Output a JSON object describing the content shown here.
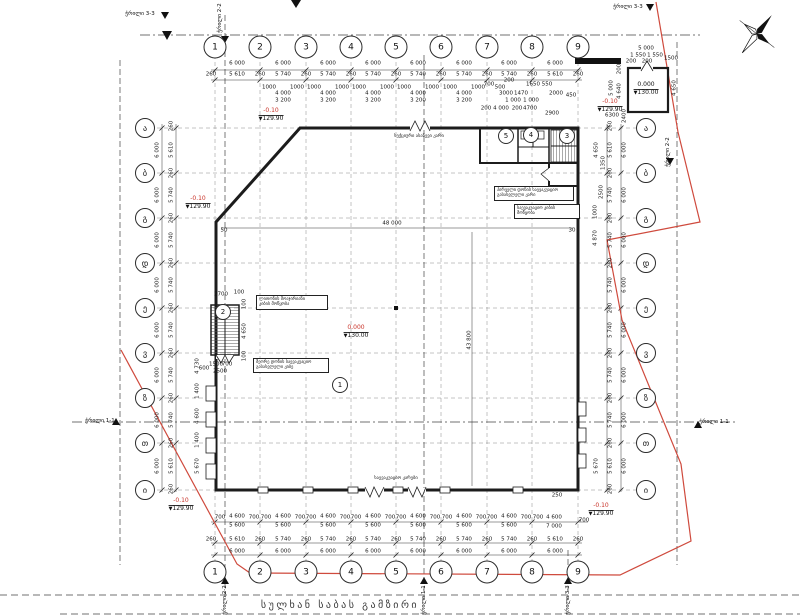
{
  "street_title": "სულხან საბას გამზირი",
  "colors": {
    "boundary_red": "#cf4a3d",
    "elevation_red": "#c9342a",
    "line_dark": "#1c1c1c"
  },
  "compass": {
    "name": "north-arrow",
    "x": 757,
    "y": 33
  },
  "axes": {
    "cols": [
      {
        "label": "1",
        "x": 215
      },
      {
        "label": "2",
        "x": 260
      },
      {
        "label": "3",
        "x": 306
      },
      {
        "label": "4",
        "x": 351
      },
      {
        "label": "5",
        "x": 396
      },
      {
        "label": "6",
        "x": 441
      },
      {
        "label": "7",
        "x": 487
      },
      {
        "label": "8",
        "x": 532
      },
      {
        "label": "9",
        "x": 578
      }
    ],
    "col_top_y": 47,
    "col_bottom_y": 572,
    "rows": [
      {
        "label": "ა",
        "y": 128
      },
      {
        "label": "ბ",
        "y": 173
      },
      {
        "label": "გ",
        "y": 218
      },
      {
        "label": "დ",
        "y": 263
      },
      {
        "label": "ე",
        "y": 308
      },
      {
        "label": "ვ",
        "y": 353
      },
      {
        "label": "ზ",
        "y": 398
      },
      {
        "label": "თ",
        "y": 443
      },
      {
        "label": "ი",
        "y": 490
      }
    ],
    "row_left_x": 145,
    "row_right_x": 646
  },
  "rooms": [
    {
      "n": "1",
      "x": 340,
      "y": 385
    },
    {
      "n": "2",
      "x": 223,
      "y": 312
    },
    {
      "n": "5",
      "x": 506,
      "y": 136
    },
    {
      "n": "4",
      "x": 531,
      "y": 135
    },
    {
      "n": "3",
      "x": 567,
      "y": 136
    }
  ],
  "elevations": [
    {
      "level": "-0.10",
      "abs": "129.90",
      "x": 271,
      "y": 108
    },
    {
      "level": "-0.10",
      "abs": "129.90",
      "x": 198,
      "y": 196
    },
    {
      "level": "-0.10",
      "abs": "129.90",
      "x": 610,
      "y": 99
    },
    {
      "level": "0.000",
      "abs": "130.00",
      "x": 356,
      "y": 325
    },
    {
      "level": "-0.10",
      "abs": "129.90",
      "x": 181,
      "y": 498
    },
    {
      "level": "-0.10",
      "abs": "129.90",
      "x": 601,
      "y": 503
    },
    {
      "level": "0.000",
      "abs": "130.00",
      "x": 646,
      "y": 82,
      "plain": true
    }
  ],
  "callouts": [
    {
      "x": 256,
      "y": 295,
      "w": 66,
      "lines": [
        "ლითონის მოაჯირიანი",
        "კიბის მოწყობა"
      ]
    },
    {
      "x": 253,
      "y": 358,
      "w": 70,
      "lines": [
        "მეორე დონის საევაკუაციო",
        "გასასვლელი კიბე"
      ]
    },
    {
      "x": 494,
      "y": 186,
      "w": 74,
      "lines": [
        "პირველი დონის საევაკუაციო",
        "გასასვლელი კარი"
      ]
    },
    {
      "x": 514,
      "y": 204,
      "w": 60,
      "lines": [
        "საევაკუაციო კიბის",
        "მოწყობა"
      ]
    }
  ],
  "plain_labels": [
    {
      "t": "სექციური ასაწევი კარი",
      "x": 419,
      "y": 134
    },
    {
      "t": "საევაკუაციო კარები",
      "x": 396,
      "y": 476
    }
  ],
  "sections": [
    {
      "t": "ჭრილი 2-2",
      "x": 220,
      "y": 18,
      "r": 1
    },
    {
      "t": "ჭრილი 2-2",
      "x": 225,
      "y": 600,
      "r": 1
    },
    {
      "t": "ჭრილი 1-1",
      "x": 424,
      "y": 600,
      "r": 1
    },
    {
      "t": "ჭრილი 3-3",
      "x": 568,
      "y": 600,
      "r": 1
    },
    {
      "t": "ჭრილი 1-1",
      "x": 100,
      "y": 421,
      "r": 0
    },
    {
      "t": "ჭრილი 1-1",
      "x": 714,
      "y": 422,
      "r": 0
    },
    {
      "t": "ჭრილი 2-2",
      "x": 668,
      "y": 152,
      "r": 1
    },
    {
      "t": "ჭრილი 3-3",
      "x": 140,
      "y": 14,
      "r": 0
    },
    {
      "t": "ჭრილი 3-3",
      "x": 628,
      "y": 7,
      "r": 0
    }
  ],
  "dims": [
    [
      "6 000",
      237,
      64
    ],
    [
      "6 000",
      283,
      64
    ],
    [
      "6 000",
      328,
      64
    ],
    [
      "6 000",
      373,
      64
    ],
    [
      "6 000",
      418,
      64
    ],
    [
      "6 000",
      464,
      64
    ],
    [
      "6 000",
      509,
      64
    ],
    [
      "6 000",
      555,
      64
    ],
    [
      "260",
      211,
      75
    ],
    [
      "5 610",
      237,
      75
    ],
    [
      "260",
      260,
      75
    ],
    [
      "5 740",
      283,
      75
    ],
    [
      "260",
      306,
      75
    ],
    [
      "5 740",
      328,
      75
    ],
    [
      "260",
      351,
      75
    ],
    [
      "5 740",
      373,
      75
    ],
    [
      "260",
      396,
      75
    ],
    [
      "5 740",
      418,
      75
    ],
    [
      "260",
      441,
      75
    ],
    [
      "5 740",
      464,
      75
    ],
    [
      "260",
      487,
      75
    ],
    [
      "5 740",
      509,
      75
    ],
    [
      "260",
      532,
      75
    ],
    [
      "5 610",
      555,
      75
    ],
    [
      "260",
      578,
      75
    ],
    [
      "1000",
      269,
      88
    ],
    [
      "1000",
      297,
      88
    ],
    [
      "4 000",
      283,
      94
    ],
    [
      "3 200",
      283,
      101
    ],
    [
      "1000",
      314,
      88
    ],
    [
      "1000",
      342,
      88
    ],
    [
      "4 000",
      328,
      94
    ],
    [
      "3 200",
      328,
      101
    ],
    [
      "1000",
      359,
      88
    ],
    [
      "1000",
      387,
      88
    ],
    [
      "4 000",
      373,
      94
    ],
    [
      "3 200",
      373,
      101
    ],
    [
      "1000",
      404,
      88
    ],
    [
      "1000",
      432,
      88
    ],
    [
      "4 000",
      418,
      94
    ],
    [
      "3 200",
      418,
      101
    ],
    [
      "1000",
      450,
      88
    ],
    [
      "1000",
      478,
      88
    ],
    [
      "4 000",
      464,
      94
    ],
    [
      "3 200",
      464,
      101
    ],
    [
      "700",
      489,
      85
    ],
    [
      "500",
      500,
      88
    ],
    [
      "200",
      509,
      81
    ],
    [
      "3000",
      506,
      94
    ],
    [
      "1470",
      521,
      94
    ],
    [
      "1650",
      533,
      85
    ],
    [
      "550",
      547,
      85
    ],
    [
      "2000",
      556,
      94
    ],
    [
      "450",
      571,
      96
    ],
    [
      "1 000",
      513,
      101
    ],
    [
      "1 000",
      531,
      101
    ],
    [
      "200",
      486,
      109
    ],
    [
      "4 000",
      501,
      109
    ],
    [
      "200",
      517,
      109
    ],
    [
      "4700",
      530,
      109
    ],
    [
      "2900",
      552,
      114
    ],
    [
      "6300",
      612,
      116
    ],
    [
      "5 000",
      646,
      49
    ],
    [
      "1 550",
      638,
      56
    ],
    [
      "1 550",
      655,
      56
    ],
    [
      "1500",
      671,
      59
    ],
    [
      "200",
      631,
      62
    ],
    [
      "200",
      647,
      62
    ],
    [
      "2400",
      625,
      116,
      1
    ],
    [
      "4 650",
      675,
      88,
      1
    ],
    [
      "5 000",
      612,
      88,
      1
    ],
    [
      "4 640",
      620,
      91,
      1
    ],
    [
      "200",
      620,
      69,
      1
    ],
    [
      "700",
      220,
      518
    ],
    [
      "4 600",
      237,
      517
    ],
    [
      "5 600",
      237,
      526
    ],
    [
      "700",
      254,
      518
    ],
    [
      "700",
      266,
      518
    ],
    [
      "4 600",
      283,
      517
    ],
    [
      "5 600",
      283,
      526
    ],
    [
      "700",
      300,
      518
    ],
    [
      "700",
      311,
      518
    ],
    [
      "4 600",
      328,
      517
    ],
    [
      "5 600",
      328,
      526
    ],
    [
      "700",
      345,
      518
    ],
    [
      "700",
      356,
      518
    ],
    [
      "4 600",
      373,
      517
    ],
    [
      "5 600",
      373,
      526
    ],
    [
      "700",
      390,
      518
    ],
    [
      "700",
      401,
      518
    ],
    [
      "4 600",
      418,
      517
    ],
    [
      "5 600",
      418,
      526
    ],
    [
      "700",
      435,
      518
    ],
    [
      "700",
      447,
      518
    ],
    [
      "4 600",
      464,
      517
    ],
    [
      "5 600",
      464,
      526
    ],
    [
      "700",
      481,
      518
    ],
    [
      "700",
      492,
      518
    ],
    [
      "4 600",
      509,
      517
    ],
    [
      "5 600",
      509,
      526
    ],
    [
      "700",
      526,
      518
    ],
    [
      "700",
      538,
      518
    ],
    [
      "4 600",
      554,
      518
    ],
    [
      "7 000",
      554,
      527
    ],
    [
      "700",
      584,
      521
    ],
    [
      "260",
      211,
      540
    ],
    [
      "5 610",
      237,
      540
    ],
    [
      "260",
      260,
      540
    ],
    [
      "5 740",
      283,
      540
    ],
    [
      "260",
      306,
      540
    ],
    [
      "5 740",
      328,
      540
    ],
    [
      "260",
      351,
      540
    ],
    [
      "5 740",
      373,
      540
    ],
    [
      "260",
      396,
      540
    ],
    [
      "5 740",
      418,
      540
    ],
    [
      "260",
      441,
      540
    ],
    [
      "5 740",
      464,
      540
    ],
    [
      "260",
      487,
      540
    ],
    [
      "5 740",
      509,
      540
    ],
    [
      "260",
      532,
      540
    ],
    [
      "5 610",
      555,
      540
    ],
    [
      "260",
      578,
      540
    ],
    [
      "6 000",
      237,
      552
    ],
    [
      "6 000",
      283,
      552
    ],
    [
      "6 000",
      328,
      552
    ],
    [
      "6 000",
      373,
      552
    ],
    [
      "6 000",
      418,
      552
    ],
    [
      "6 000",
      464,
      552
    ],
    [
      "6 000",
      509,
      552
    ],
    [
      "6 000",
      555,
      552
    ],
    [
      "6 000",
      158,
      150,
      1
    ],
    [
      "6 000",
      158,
      195,
      1
    ],
    [
      "6 000",
      158,
      240,
      1
    ],
    [
      "6 000",
      158,
      285,
      1
    ],
    [
      "6 000",
      158,
      330,
      1
    ],
    [
      "6 000",
      158,
      375,
      1
    ],
    [
      "6 000",
      158,
      420,
      1
    ],
    [
      "6 000",
      158,
      466,
      1
    ],
    [
      "260",
      172,
      126,
      1
    ],
    [
      "5 610",
      172,
      150,
      1
    ],
    [
      "260",
      172,
      173,
      1
    ],
    [
      "5 740",
      172,
      195,
      1
    ],
    [
      "260",
      172,
      218,
      1
    ],
    [
      "5 740",
      172,
      240,
      1
    ],
    [
      "260",
      172,
      263,
      1
    ],
    [
      "5 740",
      172,
      285,
      1
    ],
    [
      "260",
      172,
      308,
      1
    ],
    [
      "5 740",
      172,
      330,
      1
    ],
    [
      "260",
      172,
      353,
      1
    ],
    [
      "5 740",
      172,
      375,
      1
    ],
    [
      "260",
      172,
      398,
      1
    ],
    [
      "5 740",
      172,
      420,
      1
    ],
    [
      "260",
      172,
      443,
      1
    ],
    [
      "5 610",
      172,
      466,
      1
    ],
    [
      "260",
      172,
      489,
      1
    ],
    [
      "4 730",
      198,
      366,
      1
    ],
    [
      "1 400",
      198,
      391,
      1
    ],
    [
      "4 600",
      198,
      416,
      1
    ],
    [
      "1 400",
      198,
      440,
      1
    ],
    [
      "5 670",
      198,
      466,
      1
    ],
    [
      "2700",
      221,
      295
    ],
    [
      "100",
      239,
      293
    ],
    [
      "600",
      204,
      369
    ],
    [
      "1500",
      216,
      365
    ],
    [
      "700",
      227,
      365
    ],
    [
      "2500",
      220,
      372
    ],
    [
      "100",
      245,
      304,
      1
    ],
    [
      "4 650",
      245,
      331,
      1
    ],
    [
      "100",
      245,
      356,
      1
    ],
    [
      "6 000",
      625,
      150,
      1
    ],
    [
      "6 000",
      625,
      195,
      1
    ],
    [
      "6 000",
      625,
      240,
      1
    ],
    [
      "6 000",
      625,
      285,
      1
    ],
    [
      "6 000",
      625,
      330,
      1
    ],
    [
      "6 000",
      625,
      375,
      1
    ],
    [
      "6 000",
      625,
      420,
      1
    ],
    [
      "6 000",
      625,
      466,
      1
    ],
    [
      "260",
      611,
      126,
      1
    ],
    [
      "5 610",
      611,
      150,
      1
    ],
    [
      "260",
      611,
      173,
      1
    ],
    [
      "5 740",
      611,
      195,
      1
    ],
    [
      "260",
      611,
      218,
      1
    ],
    [
      "5 740",
      611,
      240,
      1
    ],
    [
      "260",
      611,
      263,
      1
    ],
    [
      "5 740",
      611,
      285,
      1
    ],
    [
      "260",
      611,
      308,
      1
    ],
    [
      "5 740",
      611,
      330,
      1
    ],
    [
      "260",
      611,
      353,
      1
    ],
    [
      "5 740",
      611,
      375,
      1
    ],
    [
      "260",
      611,
      398,
      1
    ],
    [
      "5 740",
      611,
      420,
      1
    ],
    [
      "260",
      611,
      443,
      1
    ],
    [
      "5 610",
      611,
      466,
      1
    ],
    [
      "260",
      611,
      489,
      1
    ],
    [
      "4 650",
      597,
      150,
      1
    ],
    [
      "1350",
      604,
      163,
      1
    ],
    [
      "2500",
      602,
      192,
      1
    ],
    [
      "1000",
      596,
      212,
      1
    ],
    [
      "4 870",
      596,
      238,
      1
    ],
    [
      "5 670",
      597,
      466,
      1
    ],
    [
      "48 000",
      392,
      224
    ],
    [
      "43 800",
      470,
      340,
      1
    ],
    [
      "50",
      224,
      231
    ],
    [
      "30",
      572,
      231
    ],
    [
      "250",
      557,
      496
    ]
  ]
}
